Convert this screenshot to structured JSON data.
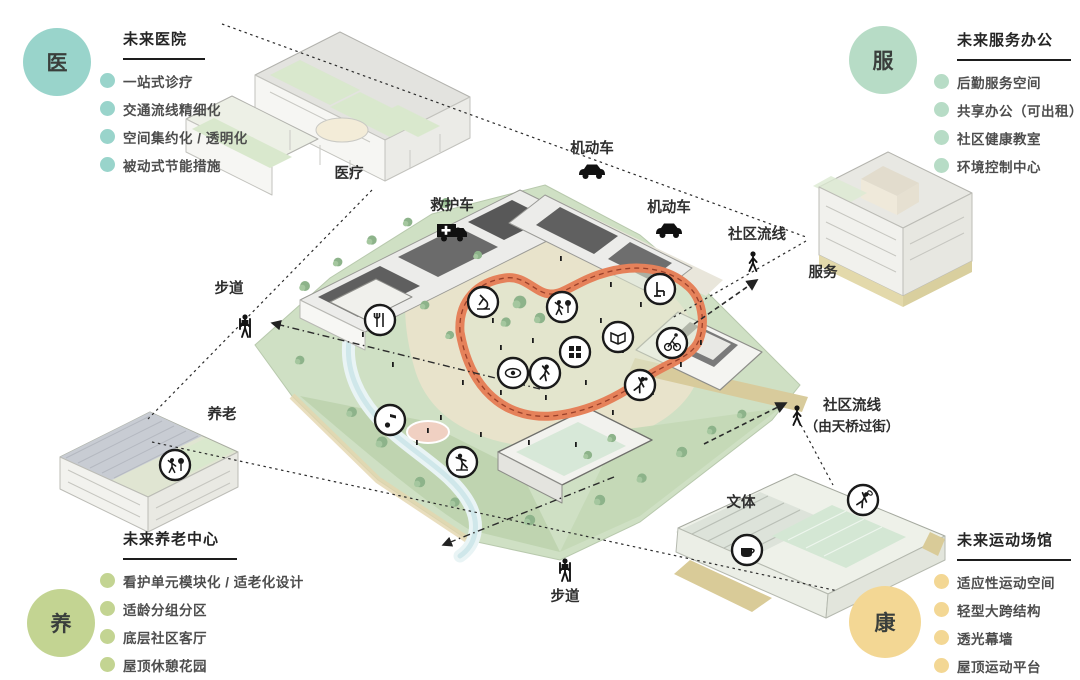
{
  "panels": {
    "medical": {
      "badge": "医",
      "accent": "#99d4cb",
      "title": "未来医院",
      "items": [
        "一站式诊疗",
        "交通流线精细化",
        "空间集约化 / 透明化",
        "被动式节能措施"
      ]
    },
    "service": {
      "badge": "服",
      "accent": "#b7dcc6",
      "title": "未来服务办公",
      "items": [
        "后勤服务空间",
        "共享办公（可出租）",
        "社区健康教室",
        "环境控制中心"
      ]
    },
    "elder": {
      "badge": "养",
      "accent": "#c3d492",
      "title": "未来养老中心",
      "items": [
        "看护单元模块化 / 适老化设计",
        "适龄分组分区",
        "底层社区客厅",
        "屋顶休憩花园"
      ]
    },
    "sport": {
      "badge": "康",
      "accent": "#f3d794",
      "title": "未来运动场馆",
      "items": [
        "适应性运动空间",
        "轻型大跨结构",
        "透光幕墙",
        "屋顶运动平台"
      ]
    }
  },
  "plan": {
    "labels": {
      "hospital_zone": "医疗",
      "motor_top": "机动车",
      "ambulance": "救护车",
      "motor_right": "机动车",
      "community_flow_top": "社区流线",
      "service_zone": "服务",
      "footpath_left": "步道",
      "elder_zone": "养老",
      "community_flow_bridge_1": "社区流线",
      "community_flow_bridge_2": "（由天桥过街）",
      "culture_zone": "文体",
      "footpath_bottom": "步道"
    },
    "track_color": "#e5815a",
    "dash_color": "#2b2b2b",
    "icon_names": [
      "car-icon",
      "ambulance-icon",
      "pedestrian-icon",
      "hiker-icon",
      "dining-icon",
      "microscope-icon",
      "park-icon",
      "chair-icon",
      "book-icon",
      "cycling-icon",
      "locker-grid-icon",
      "eye-icon",
      "fitness-icon",
      "music-icon",
      "skating-icon",
      "tabletennis-icon",
      "eldercare-icon",
      "badminton-icon",
      "coffee-icon"
    ]
  }
}
